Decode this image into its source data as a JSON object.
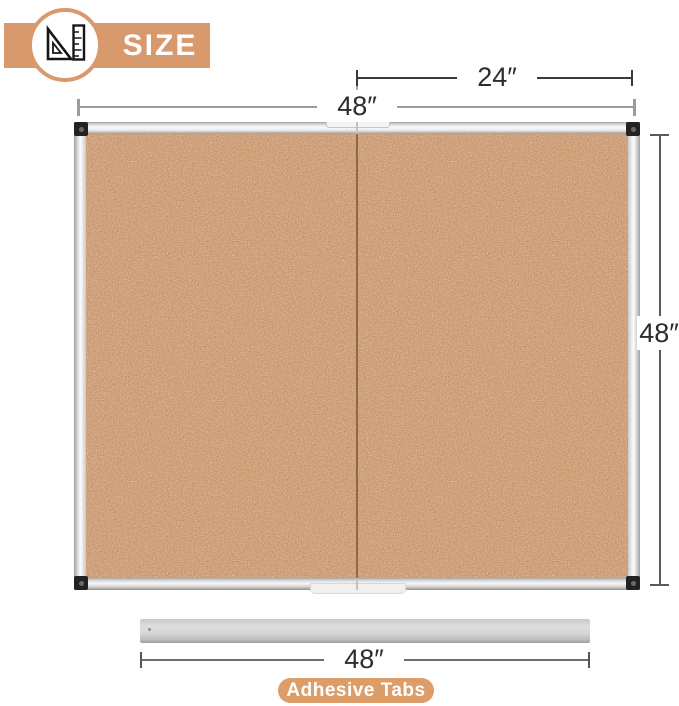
{
  "header": {
    "title": "SIZE",
    "icon": "set-square-and-ruler",
    "accent_color": "#D8996C"
  },
  "dimensions": {
    "half_width": "24″",
    "full_width_top": "48″",
    "height": "48″",
    "tab_strip_width": "48″"
  },
  "board": {
    "type": "foldable cork board with aluminum frame",
    "cork_color": "#C58E63",
    "frame_color": "#E9E9E9",
    "corner_color": "#222222",
    "fold_seam_color": "#6F5138"
  },
  "adhesive": {
    "label": "Adhesive Tabs",
    "badge_color": "#DD9D68",
    "bar_color": "#CFCFCF"
  }
}
